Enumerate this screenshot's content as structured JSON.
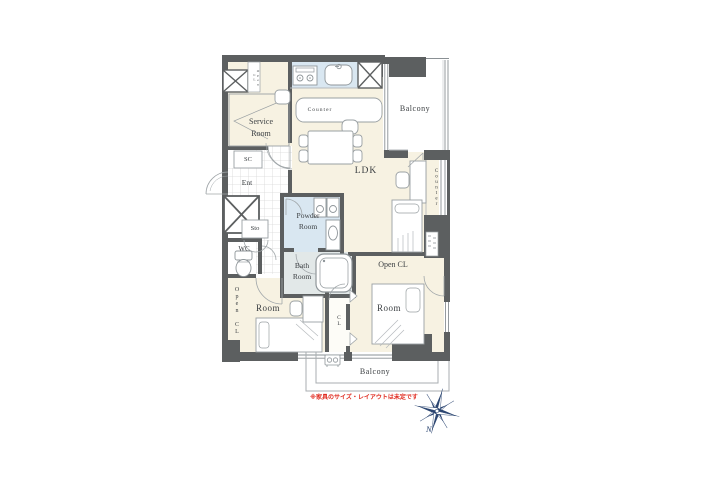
{
  "plan": {
    "labels": {
      "service_room": "Service Room",
      "open_cl_top": "Open CL",
      "sc": "SC",
      "ent": "Ent",
      "sto": "Sto",
      "wc": "WC",
      "open_cl_left": "Open CL",
      "powder_room": "Powder Room",
      "bath_room": "Bath Room",
      "counter_island": "Counter",
      "ldk": "LDK",
      "counter_window": "Counter",
      "balcony_top": "Balcony",
      "open_cl_right": "Open CL",
      "cl": "CL",
      "room_left": "Room",
      "room_right": "Room",
      "balcony_bottom": "Balcony"
    },
    "note": "※家具のサイズ・レイアウトは未定です",
    "compass_north": "N",
    "icons": [
      "stove-icon",
      "sink-icon",
      "pipe-shaft-x-icon",
      "toilet-icon",
      "washer-icon",
      "vanity-icon",
      "bathtub-icon",
      "bed-icon",
      "pillow-icon",
      "desk-icon",
      "chair-icon",
      "dining-table-icon",
      "counter-island-icon",
      "ac-outdoor-unit-icon",
      "door-swing-icon",
      "sliding-door-icon",
      "shelf-niche-icon",
      "compass-rose-icon"
    ],
    "colors": {
      "wall": "#5c5f60",
      "room_floor": "#f7f2e2",
      "wet_floor": "#d9e7f1",
      "bath_floor": "#e2e8e8",
      "note_red": "#e02b20",
      "compass_navy": "#2b4571"
    }
  }
}
